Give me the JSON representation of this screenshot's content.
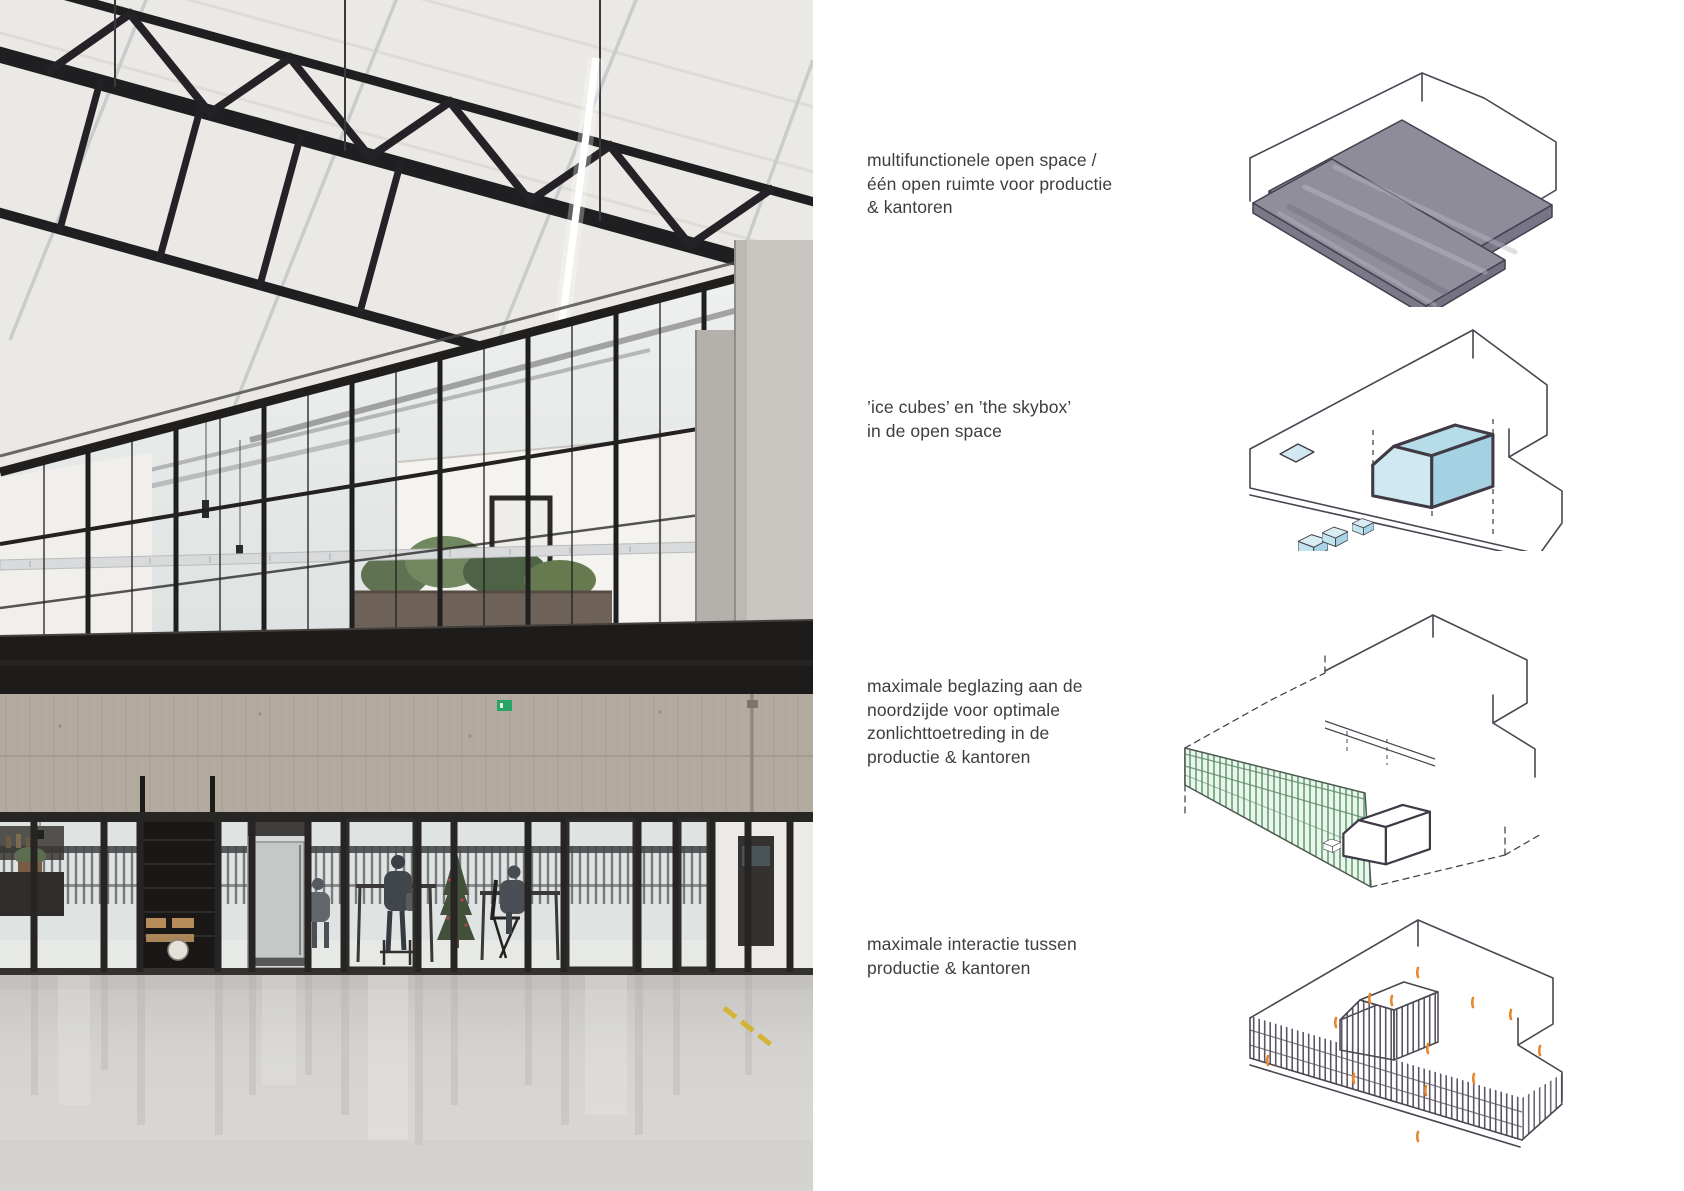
{
  "rows": [
    {
      "diagram": "open-space-diagram",
      "caption_lines": [
        "multifunctionele open space /",
        "één open ruimte voor productie",
        "& kantoren"
      ]
    },
    {
      "diagram": "ice-cubes-skybox-diagram",
      "caption_lines": [
        "’ice cubes’ en ’the skybox’",
        "in de open space"
      ]
    },
    {
      "diagram": "beglazing-diagram",
      "caption_lines": [
        "maximale beglazing aan de",
        "noordzijde voor optimale",
        "zonlichttoetreding in de",
        "productie & kantoren"
      ]
    },
    {
      "diagram": "interactie-diagram",
      "caption_lines": [
        "maximale interactie tussen",
        "productie & kantoren"
      ]
    }
  ],
  "photo": {
    "name": "industrial-hall-interior-photo"
  },
  "colors": {
    "sketch_line": "#4a4550",
    "slab_gray": "#8e8c98",
    "cube_blue": "#bfe0ec",
    "glazing_green": "#7cb28c",
    "interaction_orange": "#e8862d",
    "caption_text": "#3e3e3e",
    "exit_sign_green": "#27a566",
    "floor_marking_yellow": "#d3b22e"
  }
}
